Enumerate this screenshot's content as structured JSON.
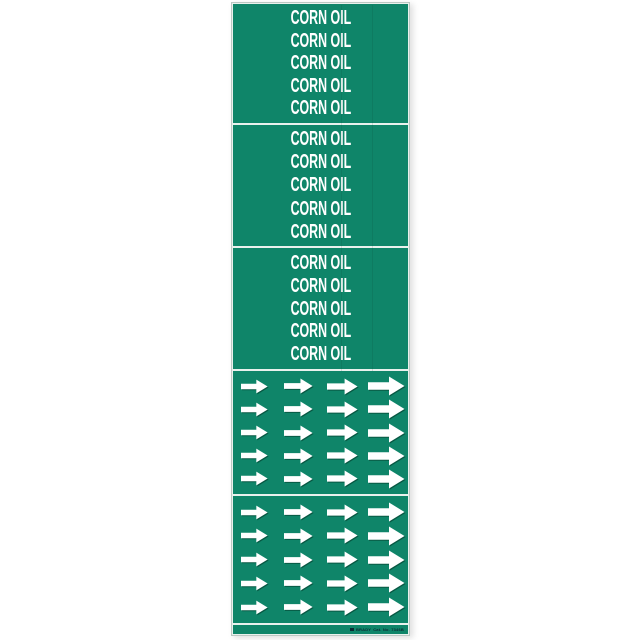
{
  "product_sheet": {
    "legend_text": "CORN OIL",
    "panels": {
      "count": 3,
      "lines_per_panel": 5
    },
    "arrow_grid": {
      "sections": 2,
      "columns": 4,
      "arrows_per_column": 5,
      "arrow_direction": "right"
    },
    "footer": {
      "brand": "BRADY",
      "catalog_text": "Cat. No. 7346B"
    },
    "colors": {
      "label_green": "#0f8569",
      "arrow_white": "#ffffff",
      "arrow_shadow": "#085843",
      "divider_white": "#e9f1ed",
      "legend_text_color": "#ffffff",
      "footer_ink": "#0b2a33"
    }
  }
}
